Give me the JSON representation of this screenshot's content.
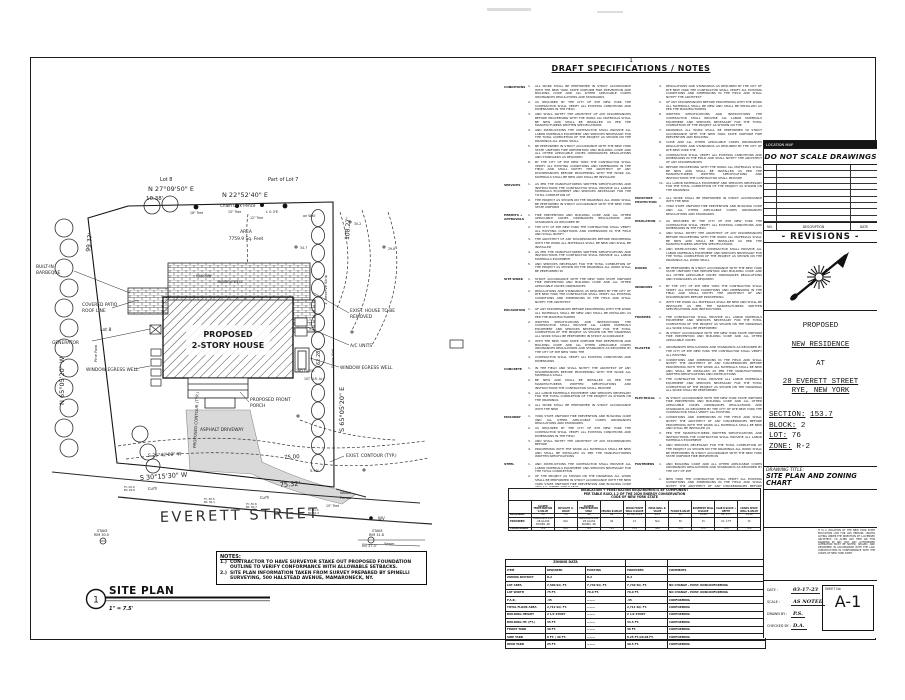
{
  "specs": {
    "sheet_number": "1",
    "title": "DRAFT SPECIFICATIONS / NOTES",
    "filler": "ALL WORK SHALL BE PERFORMED IN STRICT ACCORDANCE WITH THE NEW YORK STATE UNIFORM FIRE PREVENTION AND BUILDING CODE AND ALL OTHER APPLICABLE CODES ORDINANCES REGULATIONS AND STANDARDS AS REQUIRED BY THE CITY OF RYE NEW YORK THE CONTRACTOR SHALL VERIFY ALL EXISTING CONDITIONS AND DIMENSIONS IN THE FIELD AND SHALL NOTIFY THE ARCHITECT OF ANY DISCREPANCIES BEFORE PROCEEDING WITH THE WORK ALL MATERIALS SHALL BE NEW AND SHALL BE INSTALLED AS PER THE MANUFACTURERS WRITTEN SPECIFICATIONS AND INSTRUCTIONS THE CONTRACTOR SHALL PROVIDE ALL LABOR MATERIALS EQUIPMENT AND SERVICES NECESSARY FOR THE TOTAL COMPLETION OF THE PROJECT AS SHOWN ON THE DRAWINGS",
    "left": [
      {
        "label": "CONDITIONS",
        "items": [
          3,
          2,
          3,
          3,
          3,
          4
        ]
      },
      {
        "label": "SERVICES",
        "items": [
          3,
          2
        ]
      },
      {
        "label": "PERMITS + APPROVALS",
        "items": [
          2,
          2,
          2,
          2,
          2
        ]
      },
      {
        "label": "SITE WORK",
        "items": [
          2,
          3
        ]
      },
      {
        "label": "EXCAVATION",
        "items": [
          2,
          4,
          3,
          1
        ]
      },
      {
        "label": "CONCRETE",
        "items": [
          2,
          2,
          2,
          1
        ]
      },
      {
        "label": "MASONRY",
        "items": [
          2,
          2,
          1,
          2
        ]
      },
      {
        "label": "STEEL",
        "items": [
          2,
          3,
          2
        ]
      },
      {
        "label": "FRAMING",
        "items": [
          2,
          3,
          2,
          2,
          3
        ]
      },
      {
        "label": "",
        "items": [
          8
        ]
      }
    ],
    "right": [
      {
        "label": "",
        "start": 4,
        "items": [
          3,
          2,
          3,
          2,
          2,
          2,
          3,
          2
        ]
      },
      {
        "label": "MOISTURE PROTECTION",
        "items": [
          1,
          2
        ]
      },
      {
        "label": "INSULATION",
        "items": [
          2,
          3,
          3
        ]
      },
      {
        "label": "DOORS",
        "items": [
          3
        ]
      },
      {
        "label": "WINDOWS",
        "items": [
          3,
          2
        ]
      },
      {
        "label": "FINISHES",
        "items": [
          3,
          2
        ]
      },
      {
        "label": "PLASTER",
        "items": [
          2,
          4,
          3
        ]
      },
      {
        "label": "ELECTRICAL",
        "items": [
          4,
          3,
          2,
          3
        ]
      },
      {
        "label": "FASTENERS",
        "items": [
          2
        ]
      },
      {
        "label": "",
        "items": [
          5
        ]
      }
    ]
  },
  "ins_table": {
    "title": [
      "INSULATION + PENETRATION REQUIREMENTS BY COMPONENT",
      "PER TABLE R402.1.2 OF THE 2020 ENERGY CONSERVATION",
      "CODE OF NEW YORK STATE"
    ],
    "cols": [
      "GLAZED FENESTRATION U-VALUE",
      "SKYLIGHT U-VALUE",
      "GLAZED FENESTRATION SHGC",
      "CEILING R-VALUE",
      "WOOD FRAME WALL R-VALUE",
      "MASS WALL R-VALUE",
      "FLOOR R-VALUE",
      "BASEMENT WALL R-VALUE",
      "SLAB R-VALUE + DEPTH",
      "CRAWL SPACE WALL R-VALUE"
    ],
    "rows": [
      {
        "label": "REQUIRED",
        "vals": [
          ".32",
          ".55",
          ".40",
          "49",
          "20 OR 13+5",
          "8/13",
          "19",
          "15/19",
          "10, 2 FT",
          "15/19"
        ]
      },
      {
        "label": "PROVIDED",
        "vals": [
          "ANDERSEN 400 .28 GLASS DOORS .28",
          "N/A",
          "ANDERSEN 400 .28 GLASS DOORS .28",
          "49",
          "21",
          "N/A",
          "30",
          "15",
          "10, 2 FT",
          "15"
        ]
      },
      {
        "label": "COMPLIANCE",
        "vals": [
          "YES",
          "N/A",
          "YES",
          "YES",
          "YES",
          "N/A",
          "YES",
          "YES",
          "YES",
          "YES"
        ]
      }
    ]
  },
  "zoning_table": {
    "band": "ZONING DATA",
    "headers": [
      "ITEM",
      "REQUIRED",
      "EXISTING",
      "PROPOSED",
      "COMMENTS"
    ],
    "rows": [
      [
        "ZONING DISTRICT",
        "R-2",
        "R-2",
        "R-2",
        ""
      ],
      [
        "LOT AREA",
        "7,500 SQ. FT.",
        "7,749 SQ. FT.",
        "7,749 SQ. FT.",
        "NO CHANGE - EXIST. NONCONFORMING"
      ],
      [
        "LOT WIDTH",
        "75 FT.",
        "70.0 FT.",
        "70.0 FT.",
        "NO CHANGE - EXIST. NONCONFORMING"
      ],
      [
        "F.A.R.",
        ".35",
        "———",
        ".35",
        "CONFORMING"
      ],
      [
        "TOTAL FLOOR AREA",
        "2,712 SQ. FT.",
        "———",
        "2,711 SQ. FT.",
        "CONFORMING"
      ],
      [
        "BUILDING HEIGHT",
        "2 1/2 STORY",
        "———",
        "2 1/2 STORY",
        "CONFORMING"
      ],
      [
        "BUILDING HT. (FT.)",
        "35 FT.",
        "———",
        "34.5 FT.",
        "CONFORMING"
      ],
      [
        "FRONT YARD",
        "30 FT.",
        "———",
        "30 FT.",
        "CONFORMING"
      ],
      [
        "SIDE YARD",
        "8 FT. / 20 FT.",
        "———",
        "8.25 FT./20.08 FT.",
        "CONFORMING"
      ],
      [
        "REAR YARD",
        "25 FT.",
        "———",
        "40.5 FT.",
        "CONFORMING"
      ]
    ]
  },
  "notes": {
    "title": "NOTES:",
    "nums": [
      "1.)",
      "2.)"
    ],
    "items": [
      "CONTRACTOR TO HAVE SURVEYOR STAKE OUT PROPOSED FOUNDATION OUTLINE TO VERIFY CONFORMANCE WITH ALLOWABLE SETBACKS.",
      "SITE PLAN INFORMATION TAKEN FROM SURVEY PREPARED BY SPINELLI SURVEYING, 500 HALSTEAD AVENUE, MAMARONECK, NY."
    ]
  },
  "site_plan_label": {
    "number": "1",
    "title": "SITE PLAN",
    "scale": "1\" = 7.5'"
  },
  "plan": {
    "street_name": "EVERETT STREET",
    "labels": [
      {
        "t": "Lot 8",
        "x": 160,
        "y": 181,
        "fs": 5
      },
      {
        "t": "Part of Lot 7",
        "x": 268,
        "y": 181,
        "fs": 5
      },
      {
        "t": "N 27°09'50\" E",
        "x": 148,
        "y": 191,
        "fs": 6.5
      },
      {
        "t": "10.38'",
        "x": 146,
        "y": 200,
        "fs": 5.5
      },
      {
        "t": "N 22°52'40\" E",
        "x": 222,
        "y": 197,
        "fs": 6.5
      },
      {
        "t": "Chain   Link   Fence",
        "x": 220,
        "y": 207,
        "fs": 4.2
      },
      {
        "t": "L 0.3'E",
        "x": 266,
        "y": 213,
        "fs": 3.6
      },
      {
        "t": "on Wall",
        "x": 303,
        "y": 217,
        "fs": 3.4
      },
      {
        "t": "18\" Tree",
        "x": 190,
        "y": 214,
        "fs": 3.2
      },
      {
        "t": "15\" Tree",
        "x": 228,
        "y": 213,
        "fs": 3.2
      },
      {
        "t": "12\" Tree",
        "x": 250,
        "y": 219,
        "fs": 3.2
      },
      {
        "t": "AREA",
        "x": 246,
        "y": 233,
        "fs": 4.4,
        "a": "middle"
      },
      {
        "t": "7759.9 Sq. Feet",
        "x": 246,
        "y": 240,
        "fs": 4.4,
        "a": "middle"
      },
      {
        "t": "99.37'",
        "x": 90,
        "y": 252,
        "fs": 6,
        "r": -83
      },
      {
        "t": "108.27'",
        "x": 349,
        "y": 240,
        "fs": 6,
        "r": -87
      },
      {
        "t": "BUILT-IN",
        "x": 36,
        "y": 268,
        "fs": 4.4
      },
      {
        "t": "BARBEQUE",
        "x": 36,
        "y": 274,
        "fs": 4.4
      },
      {
        "t": "MASONRY",
        "x": 196,
        "y": 277,
        "fs": 3.2
      },
      {
        "t": "WINDOW WELL",
        "x": 218,
        "y": 283,
        "fs": 3.2
      },
      {
        "t": "COVERED PATIO",
        "x": 82,
        "y": 306,
        "fs": 4.4
      },
      {
        "t": "ROOF LINE",
        "x": 82,
        "y": 312,
        "fs": 4.4
      },
      {
        "t": "Lot 8",
        "x": 100,
        "y": 331,
        "fs": 4.6
      },
      {
        "t": "GENERATOR",
        "x": 52,
        "y": 344,
        "fs": 4.4
      },
      {
        "t": "Pine Row",
        "x": 97,
        "y": 362,
        "fs": 3.8,
        "r": -90
      },
      {
        "t": "N 65°05'20\" W",
        "x": 64,
        "y": 405,
        "fs": 6.5,
        "r": -90
      },
      {
        "t": "1' Reserve Strip",
        "x": 327,
        "y": 305,
        "fs": 3.8,
        "r": -90
      },
      {
        "t": "Stone Wall",
        "x": 334,
        "y": 368,
        "fs": 3.6,
        "r": -90
      },
      {
        "t": "S 65°05'20\" E",
        "x": 344,
        "y": 432,
        "fs": 6.5,
        "r": -90
      },
      {
        "t": "EXIST. HOUSE TO BE",
        "x": 350,
        "y": 312,
        "fs": 4.4
      },
      {
        "t": "REMOVED",
        "x": 350,
        "y": 318,
        "fs": 4.4
      },
      {
        "t": "62.28'",
        "x": 320,
        "y": 365,
        "fs": 5,
        "r": -90
      },
      {
        "t": "A/C UNITS",
        "x": 350,
        "y": 347,
        "fs": 4.4
      },
      {
        "t": "WINDOW EGRESS WELL",
        "x": 340,
        "y": 369,
        "fs": 4.4
      },
      {
        "t": "WINDOW EGRESS WELL",
        "x": 86,
        "y": 371,
        "fs": 4.4
      },
      {
        "t": "PROPOSED",
        "x": 228,
        "y": 337,
        "fs": 8,
        "a": "middle",
        "w": "bold"
      },
      {
        "t": "2-STORY HOUSE",
        "x": 228,
        "y": 348,
        "fs": 8,
        "a": "middle",
        "w": "bold"
      },
      {
        "t": "2ND FLOOR",
        "x": 296,
        "y": 372,
        "fs": 3.2
      },
      {
        "t": "1ST FLR. ALJ",
        "x": 304,
        "y": 380,
        "fs": 3.2
      },
      {
        "t": "PROPOSED FRONT",
        "x": 250,
        "y": 401,
        "fs": 4.4
      },
      {
        "t": "PORCH",
        "x": 250,
        "y": 407,
        "fs": 4.4
      },
      {
        "t": "ASPHALT DRIVEWAY",
        "x": 200,
        "y": 431,
        "fs": 4.4
      },
      {
        "t": "PROPOSED CONTOUR (TYP.)",
        "x": 196,
        "y": 448,
        "fs": 4,
        "r": -87
      },
      {
        "t": "S 25°42'00\" W",
        "x": 148,
        "y": 457,
        "fs": 4.6,
        "r": -3
      },
      {
        "t": "75.00",
        "x": 284,
        "y": 459,
        "fs": 5.5,
        "r": -3
      },
      {
        "t": "EXIST. CONTOUR (TYP.)",
        "x": 346,
        "y": 457,
        "fs": 4.4
      },
      {
        "t": "5.95'",
        "x": 310,
        "y": 472,
        "fs": 3.6
      },
      {
        "t": "S 30°15'30\" W",
        "x": 140,
        "y": 480,
        "fs": 6.5,
        "r": -4
      },
      {
        "t": "75.32'",
        "x": 280,
        "y": 487,
        "fs": 6.5,
        "r": -4
      },
      {
        "t": "Curb",
        "x": 148,
        "y": 490,
        "fs": 3.8,
        "r": -4
      },
      {
        "t": "Curb",
        "x": 260,
        "y": 499,
        "fs": 3.8,
        "r": -4
      },
      {
        "t": "Wood",
        "x": 340,
        "y": 494,
        "fs": 3.8
      },
      {
        "t": "Fence",
        "x": 340,
        "y": 499,
        "fs": 3.8
      },
      {
        "t": "15\" Tree",
        "x": 326,
        "y": 507,
        "fs": 3.2
      },
      {
        "t": "WV",
        "x": 378,
        "y": 520,
        "fs": 4
      },
      {
        "t": "STAKE",
        "x": 372,
        "y": 532,
        "fs": 3.4
      },
      {
        "t": "RIM 31.8",
        "x": 369,
        "y": 536,
        "fs": 3.4
      },
      {
        "t": "Inv 27.0'",
        "x": 362,
        "y": 547,
        "fs": 3.4
      },
      {
        "t": "Sewer",
        "x": 384,
        "y": 545,
        "fs": 3.4
      },
      {
        "t": "STAKE",
        "x": 97,
        "y": 532,
        "fs": 3.4
      },
      {
        "t": "RIM 30.0",
        "x": 94,
        "y": 536,
        "fs": 3.4
      },
      {
        "t": "TC 29.9",
        "x": 124,
        "y": 488,
        "fs": 2.8
      },
      {
        "t": "BC 29.6",
        "x": 124,
        "y": 491,
        "fs": 2.8
      },
      {
        "t": "TC 30.5",
        "x": 204,
        "y": 500,
        "fs": 2.8
      },
      {
        "t": "BC 30.1",
        "x": 204,
        "y": 503,
        "fs": 2.8
      },
      {
        "t": "TC 30.8",
        "x": 246,
        "y": 505,
        "fs": 2.8
      },
      {
        "t": "BC 30.7",
        "x": 246,
        "y": 508,
        "fs": 2.8
      },
      {
        "t": "TC 31.5",
        "x": 308,
        "y": 511,
        "fs": 2.8
      },
      {
        "t": "BC 31.3",
        "x": 308,
        "y": 514,
        "fs": 2.8
      },
      {
        "t": "34.7",
        "x": 300,
        "y": 249,
        "fs": 3.2
      },
      {
        "t": "30.2",
        "x": 354,
        "y": 225,
        "fs": 3.2
      },
      {
        "t": "29.8",
        "x": 388,
        "y": 250,
        "fs": 3.2
      }
    ]
  },
  "title_block": {
    "location_map": "LOCATION MAP",
    "do_not_scale": "DO NOT SCALE DRAWINGS",
    "rev_no": "NO.",
    "rev_desc": "DESCRIPTION",
    "rev_date": "DATE",
    "revisions_title": "- REVISIONS -",
    "proposed": "PROPOSED",
    "residence": "NEW RESIDENCE",
    "at": "AT",
    "address1": "28 EVERETT STREET",
    "address2": "RYE, NEW YORK",
    "section_label": "SECTION:",
    "section_value": "153.7",
    "block_label": "BLOCK:",
    "block_value": "2",
    "lot_label": "LOT:",
    "lot_value": "76",
    "zone_label": "ZONE:",
    "zone_value": "R-2",
    "drawing_title_label": "DRAWING TITLE:",
    "drawing_title1": "SITE PLAN AND ZONING",
    "drawing_title2": "CHART",
    "copyright": "IT IS A VIOLATION OF THE NEW YORK STATE EDUCATION LAW FOR ANY PERSON, UNLESS ACTING UNDER THE DIRECTION OF A LICENSED ARCHITECT, TO ALTER ANY ITEM ON THIS DRAWING IN ANY WAY. ANY AUTHORIZED ALTERATION MUST BE NOTED, SEALED, AND DESCRIBED IN ACCORDANCE WITH THE LAW. CONSTRUCTION IN CONFORMANCE WITH THE CODES OF NEW YORK STATE.",
    "date_label": "DATE :",
    "date_value": "03-17-23",
    "scale_label": "SCALE :",
    "scale_value": "AS NOTED",
    "drawn_label": "DRAWN BY :",
    "drawn_value": "P.S.",
    "checked_label": "CHECKED BY :",
    "checked_value": "D.A.",
    "sheet_label": "SHEET No",
    "sheet_value": "A-1",
    "empty_revision_rows": 9
  }
}
